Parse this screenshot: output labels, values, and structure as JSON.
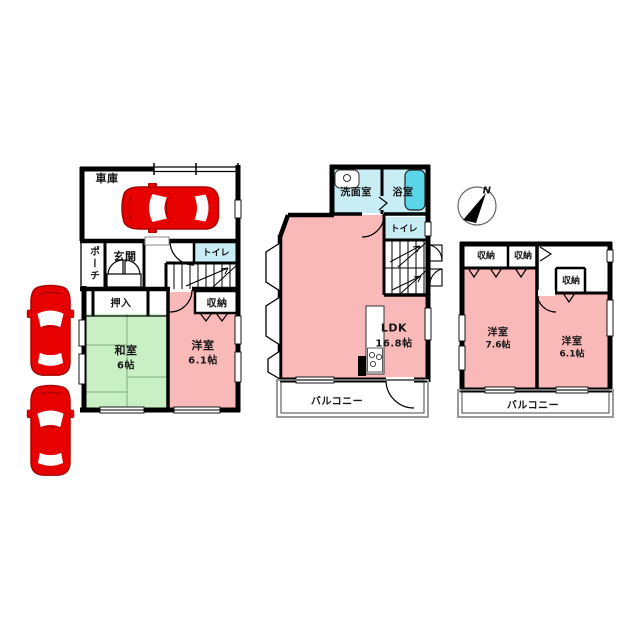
{
  "plan_type": "japanese-house-floorplan",
  "colors": {
    "room_pink": "#F9B9B9",
    "tatami_green": "#C9EFC5",
    "wet_area_blue": "#C9EDF5",
    "car_red": "#E60000",
    "wall_black": "#000000"
  },
  "floor1": {
    "garage": "車庫",
    "porch": "ポーチ",
    "entrance": "玄関",
    "toilet": "トイレ",
    "oshiire": "押入",
    "storage": "収納",
    "washitsu_name": "和室",
    "washitsu_size": "6帖",
    "youshitsu_name": "洋室",
    "youshitsu_size": "6.1帖"
  },
  "floor2": {
    "washroom": "洗面室",
    "bath": "浴室",
    "toilet": "トイレ",
    "ldk_name": "LDK",
    "ldk_size": "16.8帖",
    "balcony": "バルコニー"
  },
  "floor3": {
    "storage_a": "収納",
    "storage_b": "収納",
    "storage_c": "収納",
    "room1_name": "洋室",
    "room1_size": "7.6帖",
    "room2_name": "洋室",
    "room2_size": "6.1帖",
    "balcony": "バルコニー"
  },
  "compass": {
    "north": "N"
  }
}
